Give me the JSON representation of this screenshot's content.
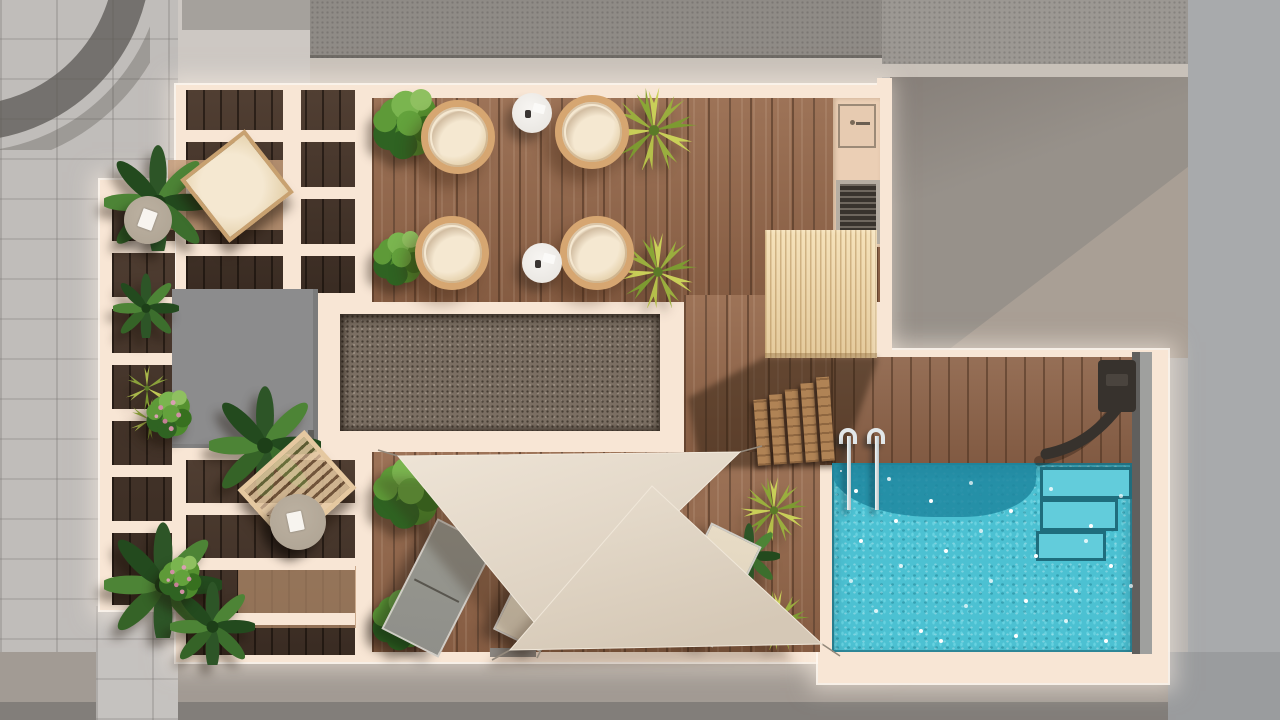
{
  "meta": {
    "type": "architectural-render",
    "view": "top-down 3D rendering of a rooftop terrace with swimming pool",
    "width_px": 1280,
    "height_px": 720,
    "visible_text": "none"
  },
  "palette": {
    "baseGrey": "#b4b1ae",
    "washTiles": "#c0bdba",
    "washLight": "#cdc8c3",
    "roofDark": "#8f8b86",
    "roofTopRight": "#9c9893",
    "band": "#c8c1b9",
    "rightGrey": "#a8aaac",
    "warmRoof": "#97918a",
    "warmRoofLight": "#aba197",
    "pavement": "#a29b94",
    "pavementDark": "#827e7a",
    "awning": "#5b5854",
    "cream": "#f8e6d5",
    "creamBright": "#fff4e8",
    "deck": "#92664a",
    "deckDark": "#46352a",
    "poolDeck": "#8a6148",
    "rugLight": "#c39b79",
    "greyBlock": "#8c8c8d",
    "gravel": "#7b6f63",
    "woodBox": "#f2dbae",
    "stepWood": "#b08355",
    "kitchen": "#ebcfb5",
    "grill": "#38332d",
    "pool": "#4cc1d2",
    "poolDark": "#1f87a0",
    "stepEdge": "#0e5d70",
    "chrome": "#e2e7e9",
    "showerDark": "#37322d",
    "chairRim": "#d6a671",
    "cushion": "#f5e8d1",
    "whiteTable": "#f3f1ed",
    "taupe": "#ada292",
    "loungerGrey": "#8f8f8a",
    "loungerBeige": "#e1d5bf",
    "woodLounger": "#e5c8a0",
    "sail": "#e6dccd",
    "sailShade": "#d9cdbc",
    "rope": "#93897c",
    "green": "#5e9a38",
    "greenDark": "#2f6322",
    "greenLight": "#8fc060",
    "tropical": "#2d5527",
    "tropicalLight": "#4d8436",
    "palmYellow": "#c9cf58",
    "palmOlive": "#9aae3e",
    "pink": "#cf8fa4"
  },
  "scene": {
    "setting": "photorealistic top-down plan of a rooftop terrace, sunlit, surroundings desaturated grey",
    "surroundings": [
      "tiled pavement street (left)",
      "dark gravel neighbouring roofs (top)",
      "lower warm-grey roof with diagonal sunlight (top right)",
      "flat grey building edge (right)",
      "grey pavement (bottom)",
      "dark curved awning (top-left corner)"
    ],
    "zones": [
      {
        "name": "pergola-lounge-upper-left",
        "features": [
          "cream slatted pergola beams over dark wood deck",
          "lounge chair with cream cushion",
          "round taupe side table with open book",
          "tropical plants"
        ]
      },
      {
        "name": "dining-terrace-top",
        "features": [
          "medium wood plank deck",
          "4 round rattan chairs with cream cushions",
          "2 small white round tables",
          "2 green boxwood bushes",
          "2 yucca palms",
          "outdoor kitchen with sink and grill"
        ]
      },
      {
        "name": "gravel-technical-strip-center",
        "features": [
          "dark gravel bed in cream frame"
        ]
      },
      {
        "name": "roof-access-block-left",
        "features": [
          "flat grey rooftop volume"
        ]
      },
      {
        "name": "pergola-lounge-lower-left",
        "features": [
          "cream slatted pergola beams",
          "flat wooden sun lounger",
          "round taupe table with open book",
          "flowering pink plants",
          "ferns"
        ]
      },
      {
        "name": "sunbathing-deck-bottom",
        "features": [
          "2 triangular beige shade sails with tension ropes",
          "1 grey sun lounger",
          "2 beige sun loungers",
          "small square side table",
          "green bushes"
        ]
      },
      {
        "name": "pool-area-right",
        "features": [
          "turquoise pool with sparkling water",
          "corner entry steps",
          "stainless-steel ladder",
          "wall-mounted dark outdoor shower",
          "light timber cabin volume",
          "5 timber stair treads",
          "yucca palms beside pool"
        ]
      }
    ],
    "counts": {
      "round_chairs": 4,
      "sun_loungers": 4,
      "shade_sails": 2,
      "side_tables": 5,
      "plants": 18,
      "pools": 1
    }
  }
}
